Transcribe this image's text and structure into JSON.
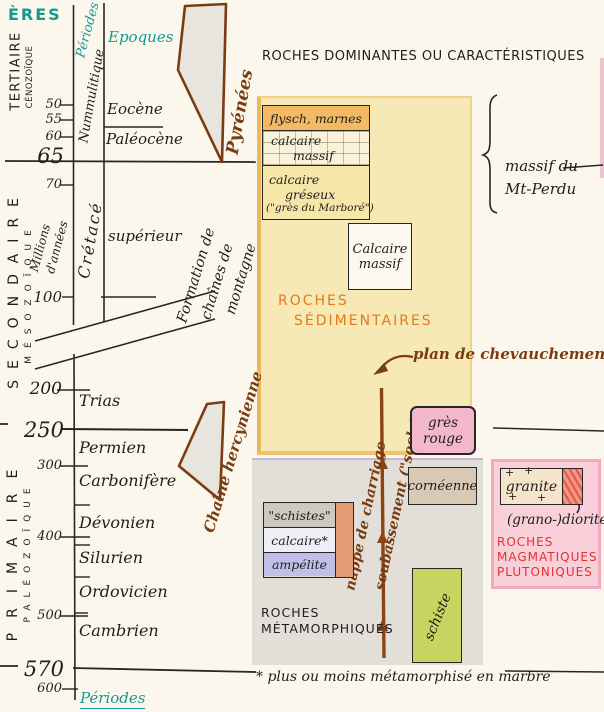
{
  "colors": {
    "teal": "#17988f",
    "brown": "#7a3c12",
    "orange_text": "#e87818",
    "red_text": "#e33030",
    "ink": "#1e1e1e",
    "yellow_region": "#f7e9b6",
    "grey_region": "#e2dfd8",
    "pink_region": "#f9d0da"
  },
  "header": {
    "title": "ROCHES DOMINANTES OU CARACTÉRISTIQUES"
  },
  "timescale": {
    "eres": "ÈRES",
    "periodes_top": "Périodes",
    "periodes_bottom": "Périodes",
    "epoques": "Epoques",
    "millions_1": "Millions",
    "millions_2": "d'années",
    "eras": [
      {
        "name": "TERTIAIRE",
        "sub": "CÉNOZOÏQUE"
      },
      {
        "name": "SECONDAIRE",
        "sub": "MÉSOZOÏQUE"
      },
      {
        "name": "PRIMAIRE",
        "sub": "PALÉOZOÏQUE"
      }
    ],
    "ages": [
      {
        "label": "50"
      },
      {
        "label": "55"
      },
      {
        "label": "60"
      },
      {
        "label": "65",
        "major": true
      },
      {
        "label": "70"
      },
      {
        "label": "100"
      },
      {
        "label": "200"
      },
      {
        "label": "250",
        "major": true
      },
      {
        "label": "300"
      },
      {
        "label": "400"
      },
      {
        "label": "500"
      },
      {
        "label": "570",
        "major": true
      },
      {
        "label": "600"
      }
    ],
    "period_nummulitique": "Nummulitique",
    "epochs": [
      {
        "label": "Eocène"
      },
      {
        "label": "Paléocène"
      }
    ],
    "period_cretace": "Crétacé",
    "cretace_stage": "supérieur",
    "periods": [
      {
        "label": "Trias"
      },
      {
        "label": "Permien"
      },
      {
        "label": "Carbonifère"
      },
      {
        "label": "Dévonien"
      },
      {
        "label": "Silurien"
      },
      {
        "label": "Ordovicien"
      },
      {
        "label": "Cambrien"
      }
    ]
  },
  "annotations": {
    "pyrenees": "Pyrénées",
    "formation_1": "Formation de",
    "formation_2": "chaînes de",
    "formation_3": "montagne",
    "hercynienne": "Chaîne hercynienne",
    "plan_chevauchement": "plan de chevauchement",
    "nappe": "nappe de charriage",
    "soubassement": "soubassement (\"socle\")",
    "massif_1": "massif du",
    "massif_2": "Mt-Perdu",
    "footnote": "* plus ou moins métamorphisé en marbre"
  },
  "rocks": {
    "sedimentaires": {
      "label_1": "ROCHES",
      "label_2": "SÉDIMENTAIRES",
      "stack": [
        {
          "label": "flysch, marnes"
        },
        {
          "label_1": "calcaire",
          "label_2": "massif"
        },
        {
          "label_1": "calcaire",
          "label_2": "gréseux",
          "label_3": "(\"grès du Marboré\")"
        }
      ],
      "calcaire_massif_1": "Calcaire",
      "calcaire_massif_2": "massif",
      "gres_rouge_1": "grès",
      "gres_rouge_2": "rouge"
    },
    "metamorphiques": {
      "label_1": "ROCHES",
      "label_2": "MÉTAMORPHIQUES",
      "stack": [
        {
          "label": "\"schistes\""
        },
        {
          "label": "calcaire*"
        },
        {
          "label": "ampélite"
        }
      ],
      "corneenne": "cornéenne",
      "schiste": "schiste"
    },
    "plutoniques": {
      "label_1": "ROCHES",
      "label_2": "MAGMATIQUES",
      "label_3": "PLUTONIQUES",
      "granite": "granite",
      "diorite": "(grano-)diorite",
      "plus": "+"
    }
  }
}
